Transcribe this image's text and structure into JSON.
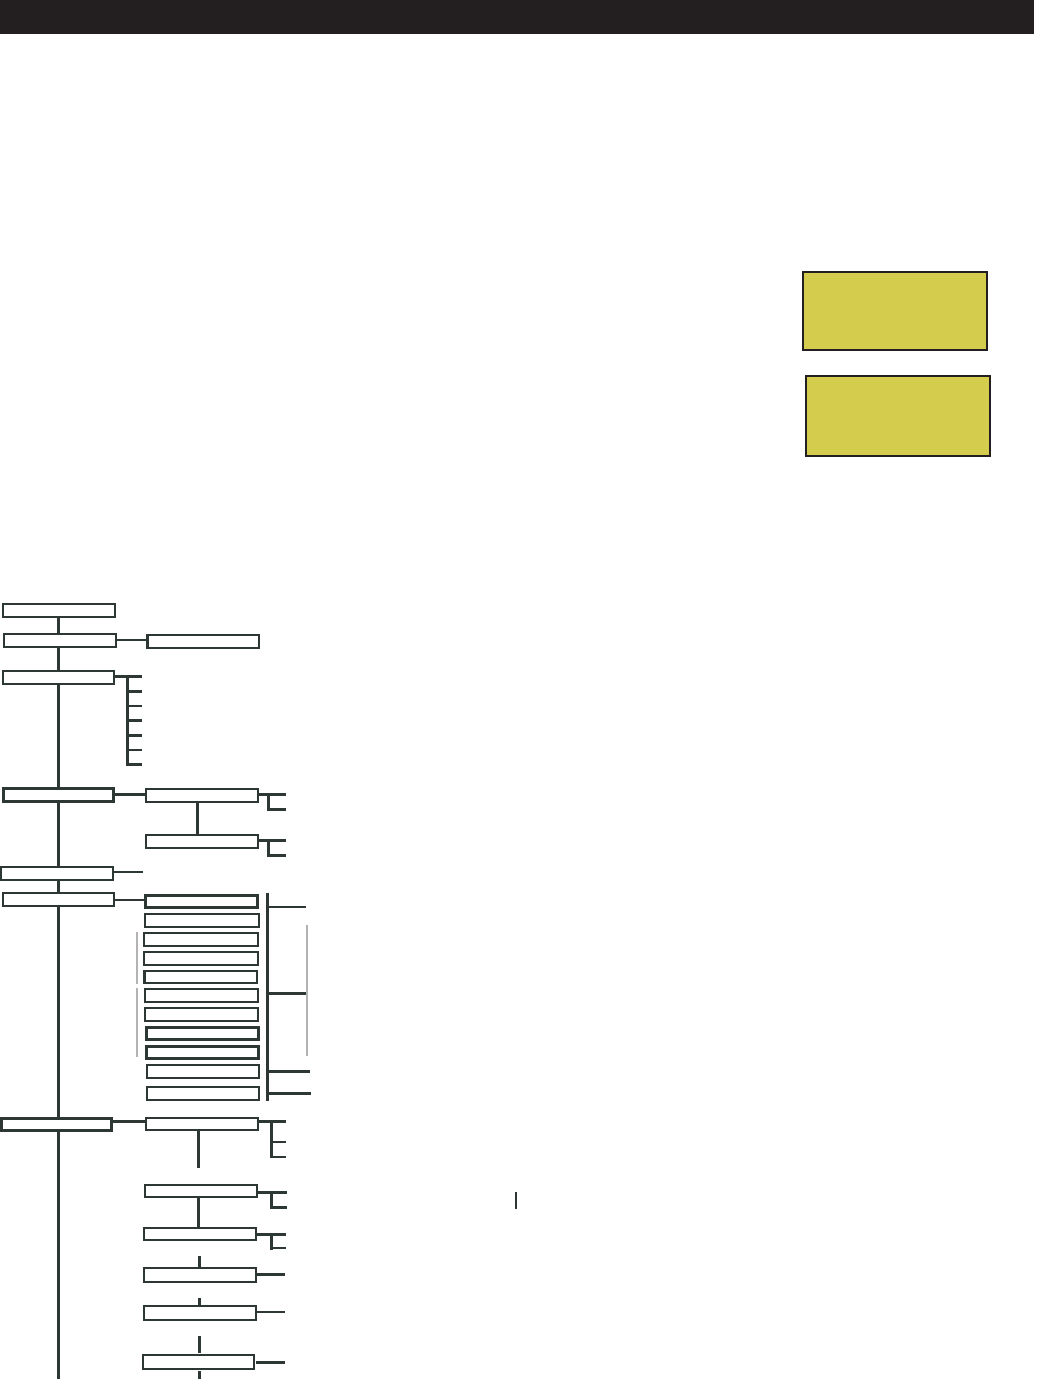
{
  "page": {
    "width": 1046,
    "height": 1379,
    "background": "#ffffff"
  },
  "header": {
    "bar_color": "#231f20",
    "x": 0,
    "y": 0,
    "w": 1034,
    "h": 34
  },
  "colors": {
    "line": "#2d3835",
    "gray_line": "#b3b3b3",
    "box_fill": "#ffffff",
    "highlight_fill": "#d3cc4c",
    "highlight_border": "#231f20"
  },
  "highlights": [
    {
      "name": "highlight-box-1",
      "x": 802,
      "y": 271,
      "w": 186,
      "h": 80
    },
    {
      "name": "highlight-box-2",
      "x": 805,
      "y": 375,
      "w": 186,
      "h": 82
    }
  ],
  "diagram": {
    "boxes": [
      {
        "name": "node-root",
        "x": 2,
        "y": 603,
        "w": 114,
        "h": 15,
        "style": ""
      },
      {
        "name": "node-level2",
        "x": 3,
        "y": 633,
        "w": 114,
        "h": 15,
        "style": ""
      },
      {
        "name": "node-level2-child",
        "x": 146,
        "y": 634,
        "w": 114,
        "h": 15,
        "style": "thick-left"
      },
      {
        "name": "node-level3",
        "x": 2,
        "y": 670,
        "w": 113,
        "h": 15,
        "style": ""
      },
      {
        "name": "node-level4",
        "x": 2,
        "y": 787,
        "w": 113,
        "h": 16,
        "style": "thick"
      },
      {
        "name": "node-level4-child1",
        "x": 145,
        "y": 788,
        "w": 114,
        "h": 15,
        "style": ""
      },
      {
        "name": "node-level4-child2",
        "x": 145,
        "y": 834,
        "w": 114,
        "h": 15,
        "style": ""
      },
      {
        "name": "node-level5",
        "x": 0,
        "y": 866,
        "w": 114,
        "h": 15,
        "style": ""
      },
      {
        "name": "node-level6",
        "x": 2,
        "y": 892,
        "w": 113,
        "h": 15,
        "style": ""
      },
      {
        "name": "stack-item-1",
        "x": 144,
        "y": 894,
        "w": 115,
        "h": 15,
        "style": "thick"
      },
      {
        "name": "stack-item-2",
        "x": 144,
        "y": 913,
        "w": 116,
        "h": 15,
        "style": ""
      },
      {
        "name": "stack-item-3",
        "x": 143,
        "y": 932,
        "w": 116,
        "h": 15,
        "style": ""
      },
      {
        "name": "stack-item-4",
        "x": 143,
        "y": 951,
        "w": 116,
        "h": 15,
        "style": ""
      },
      {
        "name": "stack-item-5",
        "x": 143,
        "y": 970,
        "w": 115,
        "h": 14,
        "style": "thick-left"
      },
      {
        "name": "stack-item-6",
        "x": 144,
        "y": 988,
        "w": 115,
        "h": 15,
        "style": ""
      },
      {
        "name": "stack-item-7",
        "x": 144,
        "y": 1007,
        "w": 115,
        "h": 15,
        "style": ""
      },
      {
        "name": "stack-item-8",
        "x": 145,
        "y": 1026,
        "w": 115,
        "h": 15,
        "style": "thick"
      },
      {
        "name": "stack-item-9",
        "x": 145,
        "y": 1045,
        "w": 115,
        "h": 15,
        "style": "thick"
      },
      {
        "name": "stack-item-10",
        "x": 146,
        "y": 1064,
        "w": 114,
        "h": 15,
        "style": ""
      },
      {
        "name": "stack-item-11",
        "x": 146,
        "y": 1086,
        "w": 114,
        "h": 15,
        "style": ""
      },
      {
        "name": "node-level7",
        "x": 0,
        "y": 1117,
        "w": 113,
        "h": 15,
        "style": "thick"
      },
      {
        "name": "node-level7-child1",
        "x": 145,
        "y": 1117,
        "w": 114,
        "h": 14,
        "style": ""
      },
      {
        "name": "node-level7-child2",
        "x": 144,
        "y": 1184,
        "w": 114,
        "h": 14,
        "style": ""
      },
      {
        "name": "node-level7-child3",
        "x": 143,
        "y": 1227,
        "w": 114,
        "h": 14,
        "style": ""
      },
      {
        "name": "node-level7-child4",
        "x": 143,
        "y": 1267,
        "w": 114,
        "h": 16,
        "style": ""
      },
      {
        "name": "node-level7-child5",
        "x": 143,
        "y": 1305,
        "w": 114,
        "h": 16,
        "style": ""
      },
      {
        "name": "node-level7-child6",
        "x": 142,
        "y": 1354,
        "w": 113,
        "h": 16,
        "style": ""
      }
    ],
    "lines": [
      {
        "name": "trunk-line",
        "x": 57,
        "y": 610,
        "w": 3,
        "h": 769,
        "tone": "dark"
      },
      {
        "name": "connector-level2",
        "x": 116,
        "y": 639,
        "w": 31,
        "h": 2,
        "tone": "dark"
      },
      {
        "name": "connector-level3",
        "x": 115,
        "y": 675,
        "w": 27,
        "h": 3,
        "tone": "dark"
      },
      {
        "name": "bracket1-vertical",
        "x": 126,
        "y": 675,
        "w": 3,
        "h": 91,
        "tone": "dark"
      },
      {
        "name": "bracket1-tick-1",
        "x": 126,
        "y": 690,
        "w": 16,
        "h": 3,
        "tone": "dark"
      },
      {
        "name": "bracket1-tick-2",
        "x": 126,
        "y": 705,
        "w": 16,
        "h": 2,
        "tone": "dark"
      },
      {
        "name": "bracket1-tick-3",
        "x": 126,
        "y": 719,
        "w": 16,
        "h": 3,
        "tone": "dark"
      },
      {
        "name": "bracket1-tick-4",
        "x": 126,
        "y": 734,
        "w": 16,
        "h": 3,
        "tone": "dark"
      },
      {
        "name": "bracket1-tick-5",
        "x": 126,
        "y": 749,
        "w": 16,
        "h": 2,
        "tone": "dark"
      },
      {
        "name": "bracket1-tick-6",
        "x": 126,
        "y": 763,
        "w": 16,
        "h": 3,
        "tone": "dark"
      },
      {
        "name": "connector-level4",
        "x": 115,
        "y": 793,
        "w": 30,
        "h": 3,
        "tone": "dark"
      },
      {
        "name": "bracket2-horizontal",
        "x": 259,
        "y": 793,
        "w": 27,
        "h": 3,
        "tone": "dark"
      },
      {
        "name": "bracket2-vertical",
        "x": 267,
        "y": 793,
        "w": 3,
        "h": 18,
        "tone": "dark"
      },
      {
        "name": "bracket2-tick",
        "x": 267,
        "y": 808,
        "w": 19,
        "h": 3,
        "tone": "dark"
      },
      {
        "name": "connector-child1-child2",
        "x": 196,
        "y": 803,
        "w": 3,
        "h": 31,
        "tone": "dark"
      },
      {
        "name": "bracket3-horizontal",
        "x": 259,
        "y": 839,
        "w": 27,
        "h": 3,
        "tone": "dark"
      },
      {
        "name": "bracket3-vertical",
        "x": 267,
        "y": 839,
        "w": 3,
        "h": 18,
        "tone": "dark"
      },
      {
        "name": "bracket3-tick",
        "x": 267,
        "y": 854,
        "w": 19,
        "h": 3,
        "tone": "dark"
      },
      {
        "name": "connector-level5-stub",
        "x": 114,
        "y": 871,
        "w": 29,
        "h": 2,
        "tone": "dark"
      },
      {
        "name": "connector-level6",
        "x": 115,
        "y": 899,
        "w": 29,
        "h": 2,
        "tone": "dark"
      },
      {
        "name": "stack-right-vertical",
        "x": 266,
        "y": 893,
        "w": 3,
        "h": 208,
        "tone": "dark"
      },
      {
        "name": "stack-tick-1",
        "x": 269,
        "y": 906,
        "w": 37,
        "h": 2,
        "tone": "dark"
      },
      {
        "name": "stack-tick-2",
        "x": 266,
        "y": 992,
        "w": 42,
        "h": 3,
        "tone": "dark"
      },
      {
        "name": "stack-tick-3",
        "x": 266,
        "y": 1070,
        "w": 44,
        "h": 3,
        "tone": "dark"
      },
      {
        "name": "stack-tick-4",
        "x": 266,
        "y": 1092,
        "w": 45,
        "h": 3,
        "tone": "dark"
      },
      {
        "name": "stack-gray-left-1",
        "x": 136,
        "y": 932,
        "w": 2,
        "h": 52,
        "tone": "gray"
      },
      {
        "name": "stack-gray-left-2",
        "x": 136,
        "y": 988,
        "w": 2,
        "h": 69,
        "tone": "gray"
      },
      {
        "name": "stack-gray-right",
        "x": 306,
        "y": 925,
        "w": 2,
        "h": 131,
        "tone": "gray"
      },
      {
        "name": "connector-level7",
        "x": 113,
        "y": 1120,
        "w": 32,
        "h": 3,
        "tone": "dark"
      },
      {
        "name": "bracket4-horizontal",
        "x": 259,
        "y": 1120,
        "w": 27,
        "h": 3,
        "tone": "dark"
      },
      {
        "name": "bracket4-vertical",
        "x": 270,
        "y": 1120,
        "w": 3,
        "h": 38,
        "tone": "dark"
      },
      {
        "name": "bracket4-tick-1",
        "x": 270,
        "y": 1141,
        "w": 16,
        "h": 2,
        "tone": "dark"
      },
      {
        "name": "bracket4-tick-2",
        "x": 270,
        "y": 1156,
        "w": 16,
        "h": 2,
        "tone": "dark"
      },
      {
        "name": "child1-down-stub",
        "x": 197,
        "y": 1131,
        "w": 3,
        "h": 37,
        "tone": "dark"
      },
      {
        "name": "bracket5-horizontal",
        "x": 258,
        "y": 1191,
        "w": 29,
        "h": 3,
        "tone": "dark"
      },
      {
        "name": "bracket5-vertical",
        "x": 270,
        "y": 1191,
        "w": 3,
        "h": 17,
        "tone": "dark"
      },
      {
        "name": "bracket5-tick",
        "x": 270,
        "y": 1206,
        "w": 17,
        "h": 3,
        "tone": "dark"
      },
      {
        "name": "connector-child2-child3",
        "x": 197,
        "y": 1198,
        "w": 3,
        "h": 29,
        "tone": "dark"
      },
      {
        "name": "bracket6-horizontal",
        "x": 257,
        "y": 1233,
        "w": 29,
        "h": 3,
        "tone": "dark"
      },
      {
        "name": "bracket6-vertical",
        "x": 270,
        "y": 1233,
        "w": 3,
        "h": 17,
        "tone": "dark"
      },
      {
        "name": "bracket6-tick",
        "x": 270,
        "y": 1247,
        "w": 16,
        "h": 2,
        "tone": "dark"
      },
      {
        "name": "floating-tick",
        "x": 515,
        "y": 1192,
        "w": 2,
        "h": 17,
        "tone": "dark"
      },
      {
        "name": "stub-above-child4",
        "x": 198,
        "y": 1256,
        "w": 3,
        "h": 11,
        "tone": "dark"
      },
      {
        "name": "child4-right-line",
        "x": 257,
        "y": 1273,
        "w": 28,
        "h": 3,
        "tone": "dark"
      },
      {
        "name": "stub-above-child5",
        "x": 198,
        "y": 1298,
        "w": 3,
        "h": 7,
        "tone": "dark"
      },
      {
        "name": "child5-right-line",
        "x": 257,
        "y": 1311,
        "w": 28,
        "h": 2,
        "tone": "dark"
      },
      {
        "name": "stub-above-child6",
        "x": 198,
        "y": 1336,
        "w": 3,
        "h": 17,
        "tone": "dark"
      },
      {
        "name": "child6-right-line",
        "x": 256,
        "y": 1361,
        "w": 29,
        "h": 3,
        "tone": "dark"
      },
      {
        "name": "stub-below-child6",
        "x": 198,
        "y": 1371,
        "w": 3,
        "h": 8,
        "tone": "dark"
      }
    ]
  }
}
